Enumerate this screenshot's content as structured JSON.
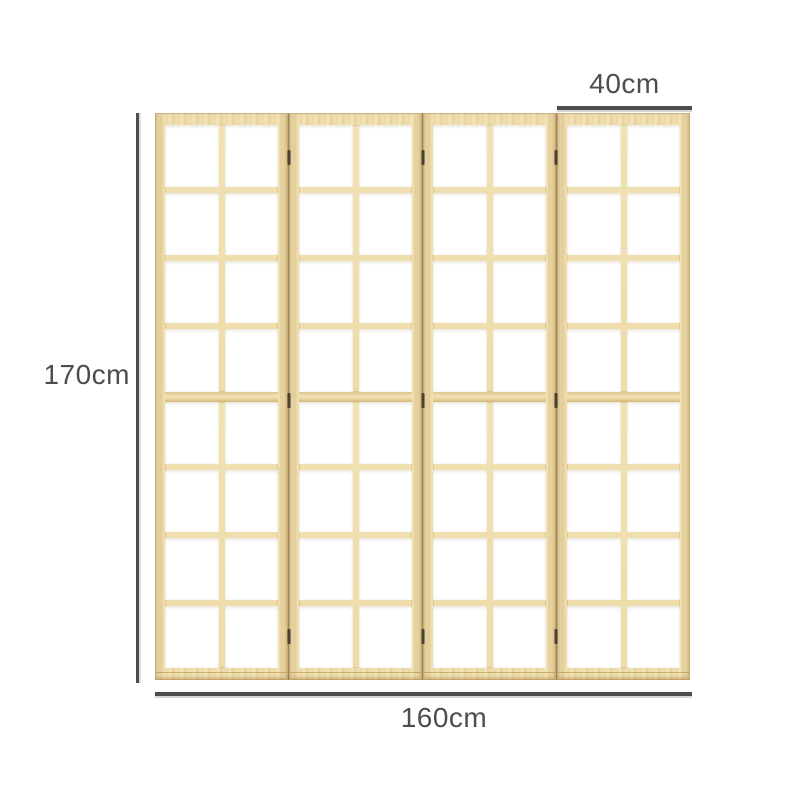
{
  "product": {
    "name": "4-panel folding room divider screen",
    "panel_count": 4,
    "pane_rows_per_panel": 8,
    "pane_cols_per_panel": 2,
    "hinges_per_seam": 3
  },
  "dimensions": {
    "height": {
      "label": "170cm"
    },
    "panel_width": {
      "label": "40cm"
    },
    "total_width": {
      "label": "160cm"
    }
  },
  "colors": {
    "background": "#ffffff",
    "wood-base": "#ecd9a6",
    "wood-light": "#f7eecf",
    "wood-dark": "#d9bd82",
    "seam": "#9b8354",
    "pane": "#ffffff",
    "hinge": "#4a4130",
    "dimension": "#4d4d4d"
  }
}
